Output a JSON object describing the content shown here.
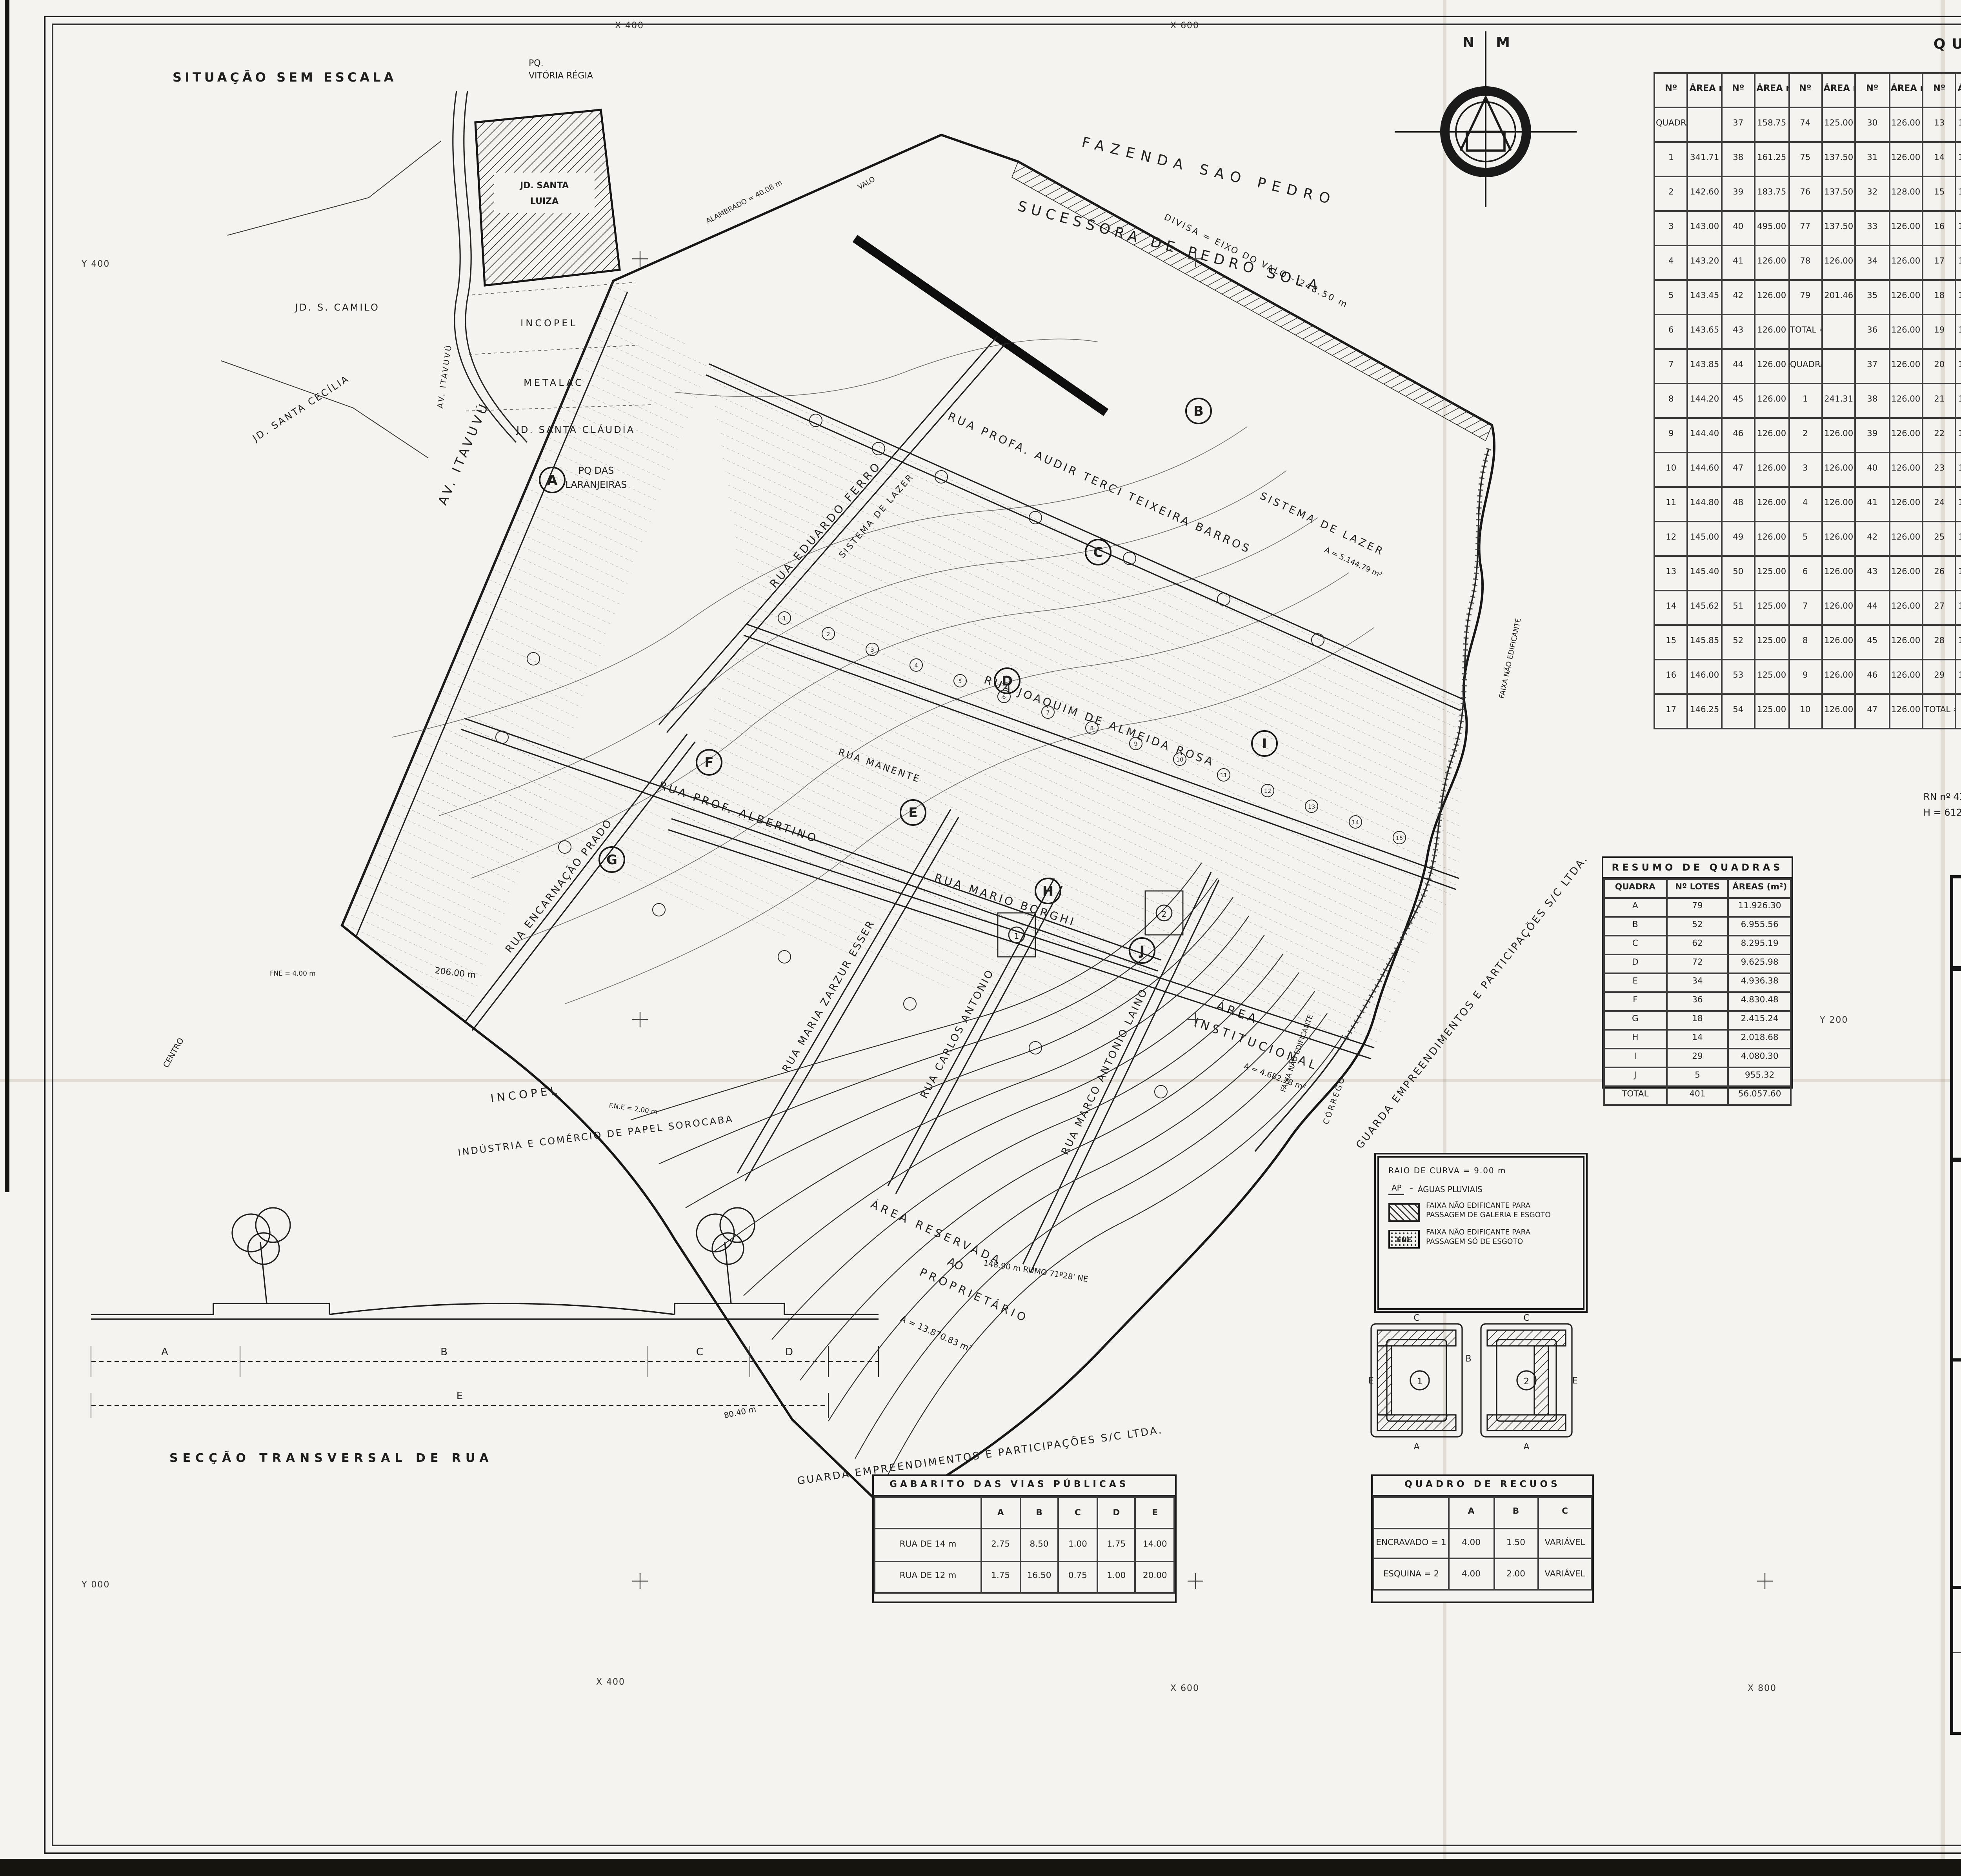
{
  "page": {
    "bg": "#f4f3ef",
    "ink": "#1c1c1c"
  },
  "grid": {
    "x400_top": "X 400",
    "x600_top": "X 600",
    "y400_left": "Y 400",
    "y600_right": "Y 600",
    "y200_mid": "Y 200",
    "x400_bot": "X 400",
    "x600_bot": "X 600",
    "x800_bot": "X 800",
    "y000_left": "Y 000"
  },
  "compass": {
    "n": "N",
    "m": "M"
  },
  "situacao": {
    "title": "SITUAÇÃO SEM ESCALA",
    "site_l1": "JD. SANTA",
    "site_l2": "LUIZA",
    "incopel": "INCOPEL",
    "metalac": "METALAC",
    "camilo": "JD. S. CAMILO",
    "cecilia": "JD. SANTA CECÍLIA",
    "claudia": "JD.  SANTA  CLÁUDIA",
    "laranjeiras_l1": "PQ  DAS",
    "laranjeiras_l2": "LARANJEIRAS",
    "vitoria_l1": "PQ.",
    "vitoria_l2": "VITÓRIA  RÉGIA",
    "itavuvu": "AV. ITAVUVÚ"
  },
  "map": {
    "fazenda_1": "FAZENDA   SAO   PEDRO",
    "fazenda_2": "SUCESSORA   DE   PEDRO   SOLA",
    "divisa": "DIVISA = EIXO DO VALO - 248.50 m",
    "alambrado": "ALAMBRADO = 40.08 m",
    "valo": "VALO",
    "r_audir": "RUA  PROFA.  AUDIR  TERCI  TEIXEIRA  BARROS",
    "r_eduardo": "RUA   EDUARDO   FERRO",
    "r_joaquim": "RUA  JOAQUIM   DE   ALMEIDA   ROSA",
    "r_mario": "RUA   MARIO   BORGHI",
    "r_albertino": "RUA    PROF.    ALBERTINO",
    "r_manente": "RUA   MANENTE",
    "r_encarnacao": "RUA ENCARNAÇÃO PRADO",
    "r_zarzur": "RUA MARIA ZARZUR ESSER",
    "r_carlos": "RUA CARLOS ANTONIO",
    "r_marco": "RUA MARCO ANTONIO LAINO",
    "av_itavuvu": "AV.  ITAVUVÚ",
    "centro": "CENTRO",
    "sistema_lazer_1": "SISTEMA  DE  LAZER",
    "sistema_lazer_1b": "A = 5.144.79 m²",
    "sistema_lazer_2": "SISTEMA DE LAZER",
    "inst_1": "ÁREA",
    "inst_2": "INSTITUCIONAL",
    "inst_3": "A = 4.682.78 m²",
    "res_1": "ÁREA  RESERVADA",
    "res_2": "AO",
    "res_3": "PROPRIETÁRIO",
    "res_area": "A = 13.870.83 m²",
    "guarda_1": "GUARDA  EMPREENDIMENTOS  E  PARTICIPAÇÕES  S/C  LTDA.",
    "guarda_2": "GUARDA  EMPREENDIMENTOS  E  PARTICIPAÇÕES  S/C  LTDA.",
    "corrego": "CÓRREGO",
    "faixa_1": "FAIXA  NÃO  EDIFICANTE",
    "faixa_2": "FAIXA  NÃO  EDIFICANTE",
    "incopel_1": "INCOPEL",
    "incopel_2": "INDÚSTRIA  E  COMÉRCIO  DE  PAPEL  SOROCABA",
    "dim_206": "206.00 m",
    "dim_148": "148.90 m   RUMO 71º28' NE",
    "dim_80": "80.40 m",
    "fne_4": "FNE = 4.00 m",
    "fne_2": "F.N.E = 2.00 m",
    "rn_1": "RN  nº 43",
    "rn_2": "H =  612.513 m",
    "quadras": [
      "A",
      "B",
      "C",
      "D",
      "E",
      "F",
      "G",
      "H",
      "I",
      "J"
    ],
    "lots": [
      "1",
      "2",
      "3",
      "4",
      "5",
      "6",
      "7",
      "8",
      "9",
      "10",
      "11",
      "12",
      "13",
      "14",
      "15"
    ]
  },
  "quadro_areas": {
    "title": "QUADRO   DE   ÁREAS",
    "rows": [
      [
        "Nº",
        "ÁREA m²",
        "Nº",
        "ÁREA m²",
        "Nº",
        "ÁREA m²",
        "Nº",
        "ÁREA m²",
        "Nº",
        "ÁREA m²",
        "Nº",
        "ÁREA m²",
        "Nº",
        "ÁREA m²",
        "Nº",
        "ÁREA m²",
        "Nº",
        "ÁREA m²",
        "Nº",
        "ÁREA m²",
        "Nº",
        "ÁREA m²",
        "Nº",
        "ÁREA m²"
      ],
      [
        "QUADRA \"A\"",
        "",
        "37",
        "158.75",
        "74",
        "125.00",
        "30",
        "126.00",
        "13",
        "126.00",
        "50",
        "126.00",
        "23",
        "126.00",
        "60",
        "126.00",
        "26",
        "125.00",
        "25",
        "123.00",
        "5",
        "126.00",
        "20",
        "126.00"
      ],
      [
        "1",
        "341.71",
        "38",
        "161.25",
        "75",
        "137.50",
        "31",
        "126.00",
        "14",
        "126.00",
        "51",
        "126.00",
        "24",
        "126.00",
        "61",
        "126.00",
        "28",
        "125.00",
        "27",
        "125.00",
        "6",
        "126.00",
        "27",
        "126.00"
      ],
      [
        "2",
        "142.60",
        "39",
        "183.75",
        "76",
        "137.50",
        "32",
        "128.00",
        "15",
        "126.00",
        "52",
        "126.00",
        "25",
        "126.00",
        "62",
        "126.00",
        "27",
        "125.00",
        "28",
        "125.00",
        "7",
        "126.00",
        "28",
        "147.00"
      ],
      [
        "3",
        "143.00",
        "40",
        "495.00",
        "77",
        "137.50",
        "33",
        "126.00",
        "16",
        "126.50",
        "53",
        "126.00",
        "26",
        "128.00",
        "63",
        "126.00",
        "29",
        "125.00",
        "29",
        "125.00",
        "8",
        "126.00",
        "29",
        "147.00"
      ],
      [
        "4",
        "143.20",
        "41",
        "126.00",
        "78",
        "126.00",
        "34",
        "126.00",
        "17",
        "126.00",
        "54",
        "126.00",
        "27",
        "126.00",
        "64",
        "126.00",
        "25",
        "123.00",
        "30",
        "123.00",
        "9",
        "126.00",
        "TOTAL = 4.030.30",
        ""
      ],
      [
        "5",
        "143.45",
        "42",
        "126.00",
        "79",
        "201.46",
        "35",
        "126.00",
        "18",
        "126.00",
        "55",
        "126.00",
        "28",
        "126.00",
        "65",
        "126.00",
        "30",
        "144.68",
        "31",
        "125.00",
        "10",
        "147.00",
        "QUADRA \"J\"",
        ""
      ],
      [
        "6",
        "143.65",
        "43",
        "126.00",
        "TOTAL = 11.926.30",
        "",
        "36",
        "126.00",
        "19",
        "126.00",
        "56",
        "126.00",
        "29",
        "126.00",
        "66",
        "126.00",
        "31",
        "128.72",
        "32",
        "128.00",
        "11",
        "147.00"
      ],
      [
        "7",
        "143.85",
        "44",
        "126.00",
        "QUADRA \"B\"",
        "",
        "37",
        "126.00",
        "20",
        "126.00",
        "57",
        "126.00",
        "30",
        "126.00",
        "67",
        "126.00",
        "32",
        "127.13",
        "33",
        "137.28",
        "12",
        "147.00",
        "1",
        "234.52"
      ],
      [
        "8",
        "144.20",
        "45",
        "126.00",
        "1",
        "241.31",
        "38",
        "126.00",
        "21",
        "126.00",
        "58",
        "126.00",
        "31",
        "126.00",
        "68",
        "126.00",
        "33",
        "127.13",
        "34",
        "126.83",
        "13",
        "147.00",
        "2",
        "168.00"
      ],
      [
        "9",
        "144.40",
        "46",
        "126.00",
        "2",
        "126.00",
        "39",
        "126.00",
        "22",
        "126.00",
        "59",
        "126.00",
        "32",
        "126.00",
        "69",
        "126.00",
        "34",
        "138.89",
        "35",
        "127.28",
        "14",
        "171.62",
        "3",
        "168.00"
      ],
      [
        "10",
        "144.60",
        "47",
        "126.00",
        "3",
        "126.00",
        "40",
        "126.00",
        "23",
        "126.00",
        "60",
        "206.74",
        "TOTAL = 4.936.38",
        "",
        "36",
        "189.26",
        "TOTAL = 2.018.68",
        "",
        "4",
        "164.74"
      ],
      [
        "11",
        "144.80",
        "48",
        "126.00",
        "4",
        "126.00",
        "41",
        "126.00",
        "24",
        "126.00",
        "TOTAL = 6.955.56",
        "",
        "QUADRA \"G\"",
        "",
        "35",
        "126.00",
        "36",
        "126.00",
        "5",
        "219.96"
      ],
      [
        "12",
        "145.00",
        "49",
        "126.00",
        "5",
        "126.00",
        "42",
        "126.00",
        "25",
        "126.00",
        "QUADRA \"C\"",
        "",
        "34",
        "126.00",
        "36",
        "126.00",
        "TOTAL = 4.080.30",
        "",
        "16",
        "126.00",
        "TOTAL = 955.32",
        ""
      ],
      [
        "13",
        "145.40",
        "50",
        "125.00",
        "6",
        "126.00",
        "43",
        "126.00",
        "26",
        "126.00",
        "1",
        "204.20",
        "35",
        "126.00",
        "QUADRA \"F\"",
        "",
        "QUADRA \"H\"",
        "",
        "17",
        "125.75",
        "QUADRA \"D\"",
        ""
      ],
      [
        "14",
        "145.62",
        "51",
        "125.00",
        "7",
        "126.00",
        "44",
        "126.00",
        "27",
        "126.00",
        "2",
        "126.00",
        "36",
        "126.00",
        "1",
        "126.00",
        "1",
        "143.28",
        "18",
        "126.83",
        "3",
        "126.45",
        "1",
        "125.98"
      ],
      [
        "15",
        "145.85",
        "52",
        "125.00",
        "8",
        "126.00",
        "45",
        "126.00",
        "28",
        "126.00",
        "3",
        "126.00",
        "37",
        "126.00",
        "2",
        "126.00",
        "2",
        "126.00",
        "19",
        "126.75",
        "4",
        "125.00",
        "2",
        "126.00"
      ],
      [
        "16",
        "146.00",
        "53",
        "125.00",
        "9",
        "126.00",
        "46",
        "126.00",
        "29",
        "126.00",
        "4",
        "126.00",
        "38",
        "126.00",
        "3",
        "126.00",
        "3",
        "126.00",
        "20",
        "126.00",
        "5",
        "125.00",
        "3",
        "126.00"
      ],
      [
        "17",
        "146.25",
        "54",
        "125.00",
        "10",
        "126.00",
        "47",
        "126.00",
        "TOTAL = 8.295.19",
        "",
        "5",
        "126.00",
        "39",
        "126.00",
        "4",
        "126.00",
        "4",
        "126.00",
        "21",
        "126.00",
        "TOTAL = 9.625.98",
        ""
      ]
    ]
  },
  "resumo": {
    "title": "RESUMO  DE  QUADRAS",
    "rows": [
      [
        "QUADRA",
        "Nº LOTES",
        "ÁREAS (m²)"
      ],
      [
        "A",
        "79",
        "11.926.30"
      ],
      [
        "B",
        "52",
        "6.955.56"
      ],
      [
        "C",
        "62",
        "8.295.19"
      ],
      [
        "D",
        "72",
        "9.625.98"
      ],
      [
        "E",
        "34",
        "4.936.38"
      ],
      [
        "F",
        "36",
        "4.830.48"
      ],
      [
        "G",
        "18",
        "2.415.24"
      ],
      [
        "H",
        "14",
        "2.018.68"
      ],
      [
        "I",
        "29",
        "4.080.30"
      ],
      [
        "J",
        "5",
        "955.32"
      ],
      [
        "TOTAL",
        "401",
        "56.057.60"
      ]
    ]
  },
  "legend": {
    "raio": "RAIO  DE  CURVA  =  9.00 m",
    "ap_sym": "AP",
    "ap_txt": "ÁGUAS  PLUVIAIS",
    "fne1_txt": "FAIXA NÃO EDIFICANTE PARA PASSAGEM DE GALERIA E ESGOTO",
    "fne2_sym": "FNE",
    "fne2_txt": "FAIXA NÃO EDIFICANTE PARA PASSAGEM SÓ DE ESGOTO"
  },
  "praca": {
    "c": "C",
    "e": "E",
    "a": "A",
    "b": "B",
    "n1": "1",
    "n2": "2"
  },
  "gabarito": {
    "title": "GABARITO   DAS   VIAS   PÚBLICAS",
    "rows": [
      [
        "",
        "A",
        "B",
        "C",
        "D",
        "E"
      ],
      [
        "RUA DE 14 m",
        "2.75",
        "8.50",
        "1.00",
        "1.75",
        "14.00"
      ],
      [
        "RUA DE 12 m",
        "1.75",
        "16.50",
        "0.75",
        "1.00",
        "20.00"
      ]
    ]
  },
  "recuos": {
    "title": "QUADRO   DE   RECUOS",
    "rows": [
      [
        "",
        "A",
        "B",
        "C"
      ],
      [
        "ENCRAVADO = 1",
        "4.00",
        "1.50",
        "VARIÁVEL"
      ],
      [
        "ESQUINA  = 2",
        "4.00",
        "2.00",
        "VARIÁVEL"
      ]
    ]
  },
  "seccao": {
    "caption": "SECÇÃO   TRANSVERSAL   DE   RUA",
    "d_a": "A",
    "d_b": "B",
    "d_c": "C",
    "d_d": "D",
    "d_e": "E"
  },
  "titleblock": {
    "title": "PROJETO  DE  LOTEAMENTO  POPULAR",
    "subtitle": "PLANO  URBANÍSTICO",
    "folha_label": "FOLHA",
    "folha_value": "1",
    "assunto_label": "ASSUNTO",
    "assunto": "JARDIM  SANTA  LUIZA",
    "prop_label": "PROPRIETÁRIO",
    "prop": "RENATO  AMARY  EMPREENDIMENTOS  IMOBILIÁRIOS  LTDA.",
    "local_label": "LOCAL",
    "local": "AV. ITAVUVÚ   -   SOROCABA / SP.",
    "data": "DATA - FEV / 87",
    "escala": "ESCALA : 1 : 1000",
    "situacao": "SITUAÇÃO  S/ ESC.",
    "vide": "VIDE  AO  LADO",
    "areas_title": "ÁREAS",
    "gleba_label": "DA   GLEBA",
    "gleba_rows": [
      [
        "DO LOTEAMENTO",
        "93 646.39 m²"
      ],
      [
        "DA RESERVADA AO PROPRIETÁRIO",
        "13 870.83 m²"
      ],
      [
        "TOTAL",
        "107 517.22 m²"
      ]
    ],
    "lote_label": "DO   LOTEAMENTO",
    "lote_rows": [
      [
        "TERRENO =",
        "93 646.39 m²",
        "100.00%"
      ],
      [
        "ÁREA DE LOTES =",
        "56 057.60 m²",
        "59.84%"
      ],
      [
        "ÁREA INSTITUCIONAL =",
        "4 682.78 m²",
        "5.00%"
      ],
      [
        "SISTEMA DE LAZER =",
        "10 797.79 m²",
        "11.52%"
      ],
      [
        "ÁREA DE RUAS =",
        "20 613.02 m²",
        "22.01%"
      ],
      [
        "FAIXA DE PROTEÇÃO AO CÓRREGO =",
        "1 525.00 m²",
        "1.63%"
      ]
    ],
    "n_lotes": "Nº DE LOTES  =  401  LOTES",
    "prop2_label": "PROPRIETÁRIO",
    "prop2_l1": "RENATO  AMARY  EMP. IMOBIL. LTDA",
    "prop2_l2": "RENATO  FAUVEL  AMARY",
    "arq_l1": "ARQº EDISON  EDUARDO  NUNES",
    "arq_l2": "AUTOR DO PROJETO E RESP. TÉCNICO",
    "arq_l3": "CREA SP Nº 44.964 /D",
    "arq_l4": "INSC. MUNIC. Nº 15.343",
    "arq_l5": "A.R.T.  Nº 806911",
    "end_l1": "AV. JUSCELINO K DE OLIVEIRA, 1043",
    "end_l2": "SOROCABA - SP.",
    "end_l3": "FONE  (0152) 32-8617",
    "des": "DES. PAULO",
    "desenho": "DESENHO  Nº 43-71 – RÔLO  EXTRA G",
    "decreto": "DECRETO  DE  APROVAÇÃO   Nº 6.022 –  21-10-87",
    "processo": "PROCESSO  Nº 2.590/87"
  }
}
